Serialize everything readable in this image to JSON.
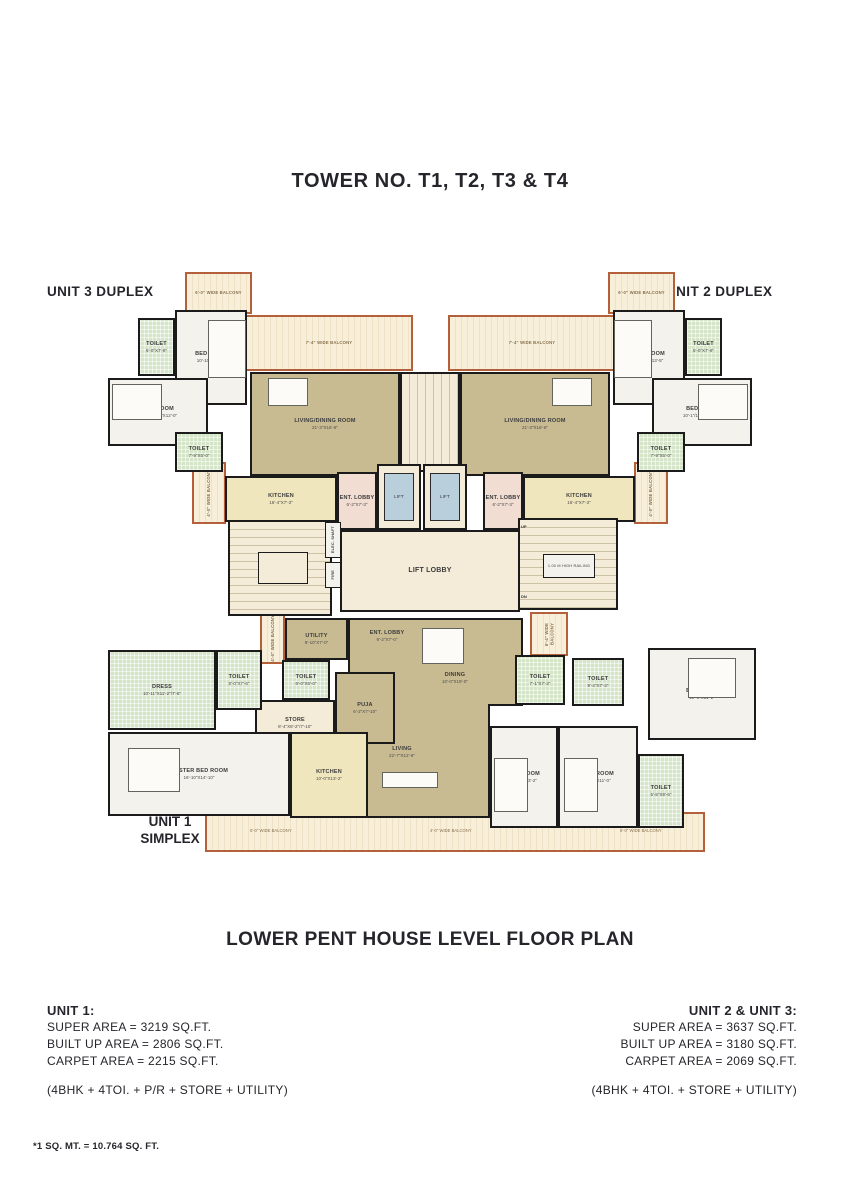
{
  "page": {
    "title": "TOWER NO. T1, T2, T3 & T4",
    "plan_title": "LOWER PENT HOUSE LEVEL FLOOR PLAN",
    "footnote": "*1 SQ. MT. = 10.764 SQ. FT."
  },
  "unit_labels": {
    "unit3": "UNIT 3 DUPLEX",
    "unit2": "UNIT 2 DUPLEX",
    "unit1_line1": "UNIT 1",
    "unit1_line2": "SIMPLEX"
  },
  "unit1_info": {
    "heading": "UNIT 1:",
    "super_area": "SUPER AREA = 3219 SQ.FT.",
    "built_up_area": "BUILT UP AREA = 2806 SQ.FT.",
    "carpet_area": "CARPET AREA = 2215 SQ.FT.",
    "config": "(4BHK + 4TOI. + P/R + STORE + UTILITY)"
  },
  "unit23_info": {
    "heading": "UNIT 2 & UNIT 3:",
    "super_area": "SUPER AREA = 3637 SQ.FT.",
    "built_up_area": "BUILT UP AREA = 3180 SQ.FT.",
    "carpet_area": "CARPET AREA = 2069 SQ.FT.",
    "config": "(4BHK + 4TOI. + STORE + UTILITY)"
  },
  "rooms": {
    "balcony_6_0": "6'-0\" WIDE BALCONY",
    "balcony_7_4": "7'-4\" WIDE BALCONY",
    "balcony_4_0": "4'-0\" WIDE BALCONY",
    "balcony_6_4": "6'-4\" WIDE BALCONY",
    "bed1": {
      "name": "BED ROOM",
      "dims": "10'-10\"X13'-5\""
    },
    "toilet1": {
      "name": "TOILET",
      "dims": "5'-0\"X7'-9\""
    },
    "bed2": {
      "name": "BED ROOM",
      "dims": "10'-1\"/11'-4\"X12'-0\""
    },
    "toilet2": {
      "name": "TOILET",
      "dims": "7'-9\"X5'-0\""
    },
    "living_dining": {
      "name": "LIVING/DINING ROOM",
      "dims": "21'-3\"X16'-6\""
    },
    "kitchen_duplex": {
      "name": "KITCHEN",
      "dims": "16'-4\"X7'-3\""
    },
    "ent_lobby_duplex": {
      "name": "ENT. LOBBY",
      "dims": "6'-2\"X7'-3\""
    },
    "lift": "LIFT",
    "lift_lobby": "LIFT LOBBY",
    "elec_shaft": "ELEC. SHAFT",
    "fire": "FIRE",
    "railing": "1.00 M HIGH RAILING",
    "up": "UP",
    "dn": "DN",
    "utility": {
      "name": "UTILITY",
      "dims": "9'-10\"X7'-0\""
    },
    "ent_lobby_1": {
      "name": "ENT. LOBBY",
      "dims": "9'-2\"X7'-0\""
    },
    "dining": {
      "name": "DINING",
      "dims": "10'-0\"X19'-0\""
    },
    "living_1": {
      "name": "LIVING",
      "dims": "22'-7\"X12'-6\""
    },
    "puja": {
      "name": "PUJA",
      "dims": "6'-2\"X7'-10\""
    },
    "toilet_pr": {
      "name": "TOILET",
      "dims": "6'-0\"X5'-0\""
    },
    "store": {
      "name": "STORE",
      "dims": "8'-4\"X8'-2\"/7'-10\""
    },
    "dress": {
      "name": "DRESS",
      "dims": "10'-11\"X11'-2\"/7'-6\""
    },
    "toilet_master": {
      "name": "TOILET",
      "dims": "8'-0\"X7'-6\""
    },
    "master_bed": {
      "name": "MASTER BED ROOM",
      "dims": "16'-10\"X14'-10\""
    },
    "kitchen_1": {
      "name": "KITCHEN",
      "dims": "10'-0\"X13'-2\""
    },
    "toilet_d1": {
      "name": "TOILET",
      "dims": "7'-1\"X7'-3\""
    },
    "toilet_d2": {
      "name": "TOILET",
      "dims": "9'-4\"X7'-3\""
    },
    "bed_tr": {
      "name": "BED ROOM",
      "dims": "10'-1\"X11'-2\""
    },
    "bed_b1": {
      "name": "BED ROOM",
      "dims": "10'-0\"X13'-2\""
    },
    "bed_b2": {
      "name": "BED ROOM",
      "dims": "11'-1\"X11'-0\""
    },
    "toilet_br": {
      "name": "TOILET",
      "dims": "5'-5\"X9'-6\""
    }
  },
  "colors": {
    "wall": "#1b1b1b",
    "balcony_border": "#b4603a",
    "floor_tan": "#c8bb92",
    "toilet_green": "#d5e5c8",
    "kitchen_yellow": "#f0e6bd",
    "lobby_cream": "#f4ecd8",
    "lift_blue": "#b9cfdc",
    "text": "#25252b"
  }
}
